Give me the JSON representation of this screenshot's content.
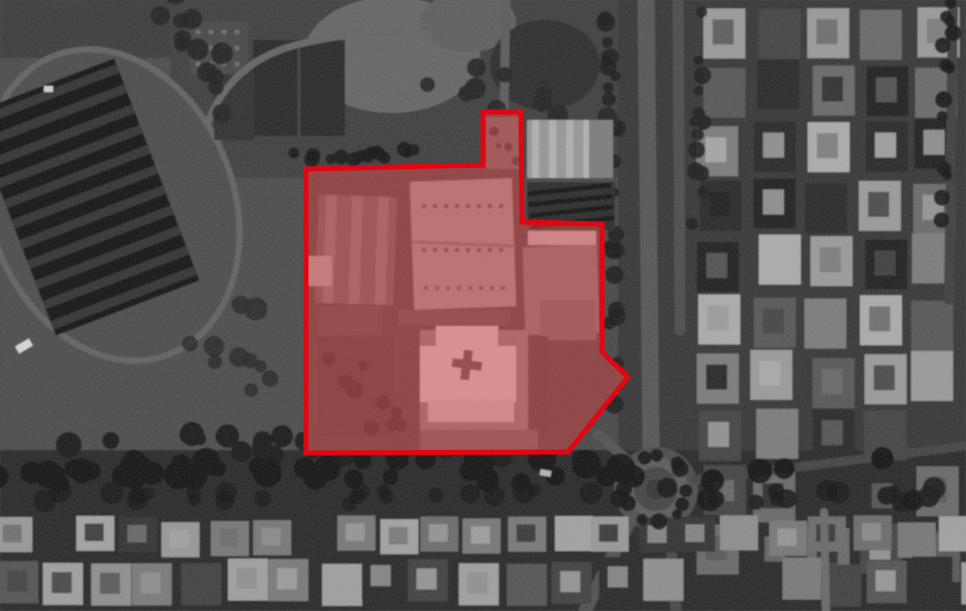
{
  "scene": {
    "kind": "grayscale-satellite-image-with-annotation",
    "palette": {
      "ground": "#484848",
      "shadow": "#141414",
      "road": "#565656",
      "roof_light": "#bfbfbf",
      "annotation_red": "#e20613"
    },
    "annotation": {
      "label": "area-of-interest-outline",
      "stroke_color": "#e20613",
      "stroke_width": 5,
      "fill_color": "#ff5252",
      "fill_opacity": 0.42,
      "points": [
        [
          306,
          169
        ],
        [
          483,
          165
        ],
        [
          483,
          112
        ],
        [
          521,
          112
        ],
        [
          522,
          222
        ],
        [
          602,
          224
        ],
        [
          602,
          352
        ],
        [
          628,
          377
        ],
        [
          568,
          452
        ],
        [
          306,
          453
        ]
      ]
    },
    "features": [
      {
        "name": "ground",
        "type": "rect",
        "x": -10,
        "y": -10,
        "w": 986,
        "h": 631,
        "fill": "#484848"
      },
      {
        "name": "field-west",
        "type": "rect",
        "x": 0,
        "y": 55,
        "w": 305,
        "h": 400,
        "fill": "#4d4d4d"
      },
      {
        "name": "top-left-band",
        "type": "rect",
        "x": 0,
        "y": 0,
        "w": 185,
        "h": 58,
        "fill": "#3e3e3e"
      },
      {
        "name": "top-center-ground",
        "type": "rect",
        "x": 170,
        "y": 0,
        "w": 465,
        "h": 178,
        "fill": "#404040"
      },
      {
        "name": "east-urban-base",
        "type": "rect",
        "x": 618,
        "y": 0,
        "w": 348,
        "h": 611,
        "fill": "#373737"
      },
      {
        "name": "south-band",
        "type": "rect",
        "x": 0,
        "y": 450,
        "w": 966,
        "h": 161,
        "fill": "#2a2a2a"
      },
      {
        "name": "track-loop",
        "type": "ellipse",
        "cx": 112,
        "cy": 205,
        "rx": 122,
        "ry": 160,
        "rot": -21,
        "fill": "#4e4e4e",
        "stroke": "#646464",
        "sw": 6
      },
      {
        "name": "stadium-roof",
        "type": "rect",
        "x": 8,
        "y": 78,
        "w": 154,
        "h": 238,
        "rot": -21,
        "fill": "#191919"
      },
      {
        "name": "stadium-roof-stripes",
        "type": "stripes",
        "x": 8,
        "y": 78,
        "w": 154,
        "h": 238,
        "rot": -21,
        "count": 11,
        "dir": "h",
        "fill": "#353535"
      },
      {
        "name": "bare-ground-patch",
        "type": "ellipse",
        "cx": 392,
        "cy": 55,
        "rx": 88,
        "ry": 58,
        "fill": "#666666"
      },
      {
        "name": "bare-ground-patch-2",
        "type": "ellipse",
        "cx": 468,
        "cy": 22,
        "rx": 48,
        "ry": 30,
        "fill": "#5e5e5e"
      },
      {
        "name": "tree-mass-north",
        "type": "ellipse",
        "cx": 545,
        "cy": 65,
        "rx": 55,
        "ry": 45,
        "fill": "#2d2d2d"
      },
      {
        "name": "warehouse-north-a",
        "type": "rect",
        "x": 253,
        "y": 40,
        "w": 92,
        "h": 96,
        "fill": "#2a2a2a"
      },
      {
        "name": "warehouse-north-a-ridge",
        "type": "line",
        "x1": 299,
        "y1": 40,
        "x2": 299,
        "y2": 136,
        "stroke": "#3f3f3f",
        "sw": 3
      },
      {
        "name": "warehouse-north-b",
        "type": "rect",
        "x": 214,
        "y": 62,
        "w": 40,
        "h": 78,
        "fill": "#323232"
      },
      {
        "name": "vent-roof",
        "type": "rect",
        "x": 190,
        "y": 22,
        "w": 58,
        "h": 52,
        "fill": "#4a4a4a"
      },
      {
        "name": "vent-roof-dots",
        "type": "dots",
        "x": 198,
        "y": 32,
        "cols": 4,
        "rows": 3,
        "dx": 13,
        "dy": 16,
        "r": 2.5,
        "fill": "#6e6e6e"
      },
      {
        "name": "access-road-north",
        "type": "path",
        "d": "M 208,122 Q 232,60 300,44 T 428,34",
        "stroke": "#656565",
        "sw": 7
      },
      {
        "name": "north-road",
        "type": "line",
        "x1": 506,
        "y1": 0,
        "x2": 504,
        "y2": 112,
        "stroke": "#5c5c5c",
        "sw": 9
      },
      {
        "name": "urban-grid-east",
        "type": "grid",
        "x": 700,
        "y": 6,
        "cols": 6,
        "rows": 10,
        "cw": 42,
        "ch": 50,
        "gx": 12,
        "gy": 8,
        "seed": 31,
        "jitter": 5,
        "skip": 0.06,
        "inner": true,
        "palette": [
          "#9a9a9a",
          "#7b7b7b",
          "#595959",
          "#2c2c2c",
          "#ababab",
          "#454545",
          "#6a6a6a",
          "#242424"
        ]
      },
      {
        "name": "right-edge-road",
        "type": "line",
        "x1": 953,
        "y1": 0,
        "x2": 949,
        "y2": 300,
        "stroke": "#414141",
        "sw": 10
      },
      {
        "name": "boulevard-west-lane",
        "type": "path",
        "d": "M 646,0 L 651,447",
        "stroke": "#565656",
        "sw": 17
      },
      {
        "name": "boulevard-east-lane",
        "type": "path",
        "d": "M 678,0 L 680,330",
        "stroke": "#4d4d4d",
        "sw": 11
      },
      {
        "name": "roundabout-pad",
        "type": "circle",
        "cx": 656,
        "cy": 489,
        "r": 42,
        "fill": "#4e4e4e"
      },
      {
        "name": "roundabout-ring",
        "type": "circle",
        "cx": 656,
        "cy": 489,
        "r": 27,
        "fill": "#444444",
        "stroke": "#5d5d5d",
        "sw": 10
      },
      {
        "name": "roundabout-island",
        "type": "circle",
        "cx": 656,
        "cy": 489,
        "r": 10,
        "fill": "#383838"
      },
      {
        "name": "road-southwest",
        "type": "line",
        "x1": 633,
        "y1": 515,
        "x2": 585,
        "y2": 611,
        "stroke": "#515151",
        "sw": 13
      },
      {
        "name": "road-south",
        "type": "line",
        "x1": 669,
        "y1": 522,
        "x2": 676,
        "y2": 611,
        "stroke": "#494949",
        "sw": 11
      },
      {
        "name": "road-east",
        "type": "line",
        "x1": 694,
        "y1": 480,
        "x2": 966,
        "y2": 446,
        "stroke": "#454545",
        "sw": 9
      },
      {
        "name": "road-northwest-stub",
        "type": "line",
        "x1": 626,
        "y1": 459,
        "x2": 598,
        "y2": 434,
        "stroke": "#525252",
        "sw": 10
      },
      {
        "name": "bottom-house-row-1",
        "type": "grid",
        "x": -8,
        "y": 519,
        "cols": 23,
        "rows": 1,
        "cw": 38,
        "ch": 35,
        "gx": 5,
        "gy": 0,
        "seed": 32,
        "jitter": 4,
        "skip": 0.05,
        "inner": true,
        "palette": [
          "#8d8d8d",
          "#a2a2a2",
          "#6d6d6d",
          "#343434",
          "#787878",
          "#989898"
        ]
      },
      {
        "name": "bottom-house-row-2",
        "type": "grid",
        "x": -4,
        "y": 560,
        "cols": 22,
        "rows": 1,
        "cw": 40,
        "ch": 42,
        "gx": 6,
        "gy": 0,
        "seed": 33,
        "jitter": 5,
        "skip": 0.05,
        "inner": true,
        "palette": [
          "#555555",
          "#7a7a7a",
          "#2b2b2b",
          "#8f8f8f",
          "#424242",
          "#9f9f9f"
        ]
      },
      {
        "name": "bottom-road-vertical",
        "type": "line",
        "x1": 824,
        "y1": 512,
        "x2": 826,
        "y2": 611,
        "stroke": "#6b6b6b",
        "sw": 8
      },
      {
        "name": "tree-row-field-south",
        "type": "blobs",
        "x1": 10,
        "y1": 441,
        "x2": 600,
        "y2": 450,
        "count": 30,
        "rmin": 6,
        "rmax": 13,
        "spread": 10,
        "seed": 11,
        "fill": "#1b1b1b"
      },
      {
        "name": "tree-band-south",
        "type": "blobs",
        "x1": 0,
        "y1": 472,
        "x2": 966,
        "y2": 468,
        "count": 48,
        "rmin": 8,
        "rmax": 15,
        "spread": 13,
        "seed": 12,
        "fill": "#141414"
      },
      {
        "name": "tree-band-south-2",
        "type": "blobs",
        "x1": 0,
        "y1": 498,
        "x2": 966,
        "y2": 494,
        "count": 40,
        "rmin": 6,
        "rmax": 12,
        "spread": 9,
        "seed": 18,
        "fill": "#1a1a1a"
      },
      {
        "name": "boulevard-median-trees",
        "type": "blobs",
        "x1": 612,
        "y1": 8,
        "x2": 610,
        "y2": 438,
        "count": 26,
        "rmin": 5,
        "rmax": 10,
        "spread": 7,
        "seed": 13,
        "fill": "#1e1e1e"
      },
      {
        "name": "boulevard-east-trees",
        "type": "blobs",
        "x1": 700,
        "y1": 0,
        "x2": 697,
        "y2": 300,
        "count": 16,
        "rmin": 5,
        "rmax": 9,
        "spread": 6,
        "seed": 14,
        "fill": "#212121"
      },
      {
        "name": "right-edge-trees",
        "type": "blobs",
        "x1": 948,
        "y1": 0,
        "x2": 944,
        "y2": 280,
        "count": 14,
        "rmin": 5,
        "rmax": 9,
        "spread": 6,
        "seed": 15,
        "fill": "#191919"
      },
      {
        "name": "roundabout-trees",
        "type": "ring",
        "cx": 656,
        "cy": 489,
        "r": 32,
        "count": 12,
        "rmin": 5,
        "rmax": 9,
        "seed": 16,
        "fill": "#181818"
      },
      {
        "name": "field-scrub",
        "type": "blobs",
        "x1": 215,
        "y1": 310,
        "x2": 300,
        "y2": 425,
        "count": 10,
        "rmin": 6,
        "rmax": 12,
        "spread": 35,
        "seed": 17,
        "fill": "#2a2a2a"
      },
      {
        "name": "tree-mass-top-center",
        "type": "blobs",
        "x1": 178,
        "y1": 10,
        "x2": 255,
        "y2": 135,
        "count": 12,
        "rmin": 7,
        "rmax": 13,
        "spread": 20,
        "seed": 22,
        "fill": "#232323"
      },
      {
        "name": "tree-row-north-of-aoi",
        "type": "blobs",
        "x1": 292,
        "y1": 157,
        "x2": 478,
        "y2": 151,
        "count": 15,
        "rmin": 5,
        "rmax": 8,
        "spread": 5,
        "seed": 21,
        "fill": "#191919"
      },
      {
        "name": "tree-scatter-northeast",
        "type": "blobs",
        "x1": 430,
        "y1": 75,
        "x2": 608,
        "y2": 115,
        "count": 13,
        "rmin": 6,
        "rmax": 11,
        "spread": 22,
        "seed": 23,
        "fill": "#262626"
      },
      {
        "name": "aoi-ground",
        "type": "polygon",
        "points": [
          [
            306,
            169
          ],
          [
            483,
            165
          ],
          [
            483,
            112
          ],
          [
            521,
            112
          ],
          [
            522,
            222
          ],
          [
            602,
            224
          ],
          [
            602,
            352
          ],
          [
            628,
            377
          ],
          [
            568,
            452
          ],
          [
            306,
            453
          ]
        ],
        "fill": "#3c3c3c"
      },
      {
        "name": "west-hall",
        "type": "rect",
        "x": 317,
        "y": 196,
        "w": 78,
        "h": 108,
        "rot": 2,
        "fill": "#585858"
      },
      {
        "name": "west-hall-ridges",
        "type": "stripes",
        "x": 317,
        "y": 196,
        "w": 78,
        "h": 108,
        "rot": 2,
        "count": 3,
        "dir": "v",
        "fill": "#6f6f6f"
      },
      {
        "name": "west-hall-annex",
        "type": "rect",
        "x": 318,
        "y": 306,
        "w": 64,
        "h": 70,
        "fill": "#454545"
      },
      {
        "name": "west-bright-shed",
        "type": "rect",
        "x": 306,
        "y": 256,
        "w": 26,
        "h": 30,
        "fill": "#9b9b9b"
      },
      {
        "name": "main-hall",
        "type": "rect",
        "x": 412,
        "y": 180,
        "w": 102,
        "h": 128,
        "rot": -2,
        "fill": "#8a8a8a"
      },
      {
        "name": "main-hall-seam",
        "type": "line",
        "x1": 413,
        "y1": 242,
        "x2": 514,
        "y2": 246,
        "stroke": "#6a6a6a",
        "sw": 3
      },
      {
        "name": "main-hall-vents-1",
        "type": "dots",
        "x": 424,
        "y": 206,
        "cols": 8,
        "rows": 1,
        "dx": 11,
        "dy": 0,
        "r": 2.4,
        "fill": "#4f4f4f"
      },
      {
        "name": "main-hall-vents-2",
        "type": "dots",
        "x": 424,
        "y": 250,
        "cols": 8,
        "rows": 1,
        "dx": 11,
        "dy": 0,
        "r": 2.4,
        "fill": "#4f4f4f"
      },
      {
        "name": "main-hall-vents-3",
        "type": "dots",
        "x": 426,
        "y": 288,
        "cols": 8,
        "rows": 1,
        "dx": 11,
        "dy": 0,
        "r": 2.4,
        "fill": "#565656"
      },
      {
        "name": "east-hall-roof-strip",
        "type": "rect",
        "x": 528,
        "y": 231,
        "w": 68,
        "h": 14,
        "fill": "#aaaaaa"
      },
      {
        "name": "east-hall",
        "type": "rect",
        "x": 524,
        "y": 246,
        "w": 74,
        "h": 88,
        "rot": -2,
        "fill": "#6f6f6f"
      },
      {
        "name": "east-hall-wing",
        "type": "rect",
        "x": 540,
        "y": 300,
        "w": 56,
        "h": 40,
        "fill": "#626262"
      },
      {
        "name": "east-inner-shadow",
        "type": "rect",
        "x": 524,
        "y": 336,
        "w": 24,
        "h": 96,
        "fill": "#3a3a3a"
      },
      {
        "name": "cross-pad",
        "type": "rect",
        "x": 398,
        "y": 330,
        "w": 130,
        "h": 104,
        "fill": "#757575"
      },
      {
        "name": "cross-pad-shadow",
        "type": "rect",
        "x": 398,
        "y": 330,
        "w": 22,
        "h": 104,
        "fill": "#3d3d3d"
      },
      {
        "name": "cross-building-horizontal",
        "type": "rect",
        "x": 420,
        "y": 346,
        "w": 96,
        "h": 56,
        "fill": "#bfbfbf"
      },
      {
        "name": "cross-building-vertical",
        "type": "rect",
        "x": 436,
        "y": 326,
        "w": 62,
        "h": 96,
        "fill": "#bfbfbf"
      },
      {
        "name": "cross-apron",
        "type": "rect",
        "x": 428,
        "y": 400,
        "w": 86,
        "h": 22,
        "fill": "#b2b2b2"
      },
      {
        "name": "cross-mark-horizontal",
        "type": "rect",
        "x": 452,
        "y": 360,
        "w": 30,
        "h": 9,
        "rot": 8,
        "fill": "#4a4a4a"
      },
      {
        "name": "cross-mark-vertical",
        "type": "rect",
        "x": 462,
        "y": 350,
        "w": 9,
        "h": 30,
        "rot": 8,
        "fill": "#4a4a4a"
      },
      {
        "name": "southwest-yard",
        "type": "rect",
        "x": 318,
        "y": 336,
        "w": 76,
        "h": 100,
        "fill": "#393939"
      },
      {
        "name": "yard-structures",
        "type": "blobs",
        "x1": 325,
        "y1": 345,
        "x2": 390,
        "y2": 430,
        "count": 9,
        "rmin": 5,
        "rmax": 10,
        "spread": 18,
        "seed": 24,
        "fill": "#262626"
      },
      {
        "name": "south-strip-light",
        "type": "rect",
        "x": 420,
        "y": 430,
        "w": 118,
        "h": 20,
        "fill": "#585858"
      },
      {
        "name": "mid-lane",
        "type": "rect",
        "x": 398,
        "y": 310,
        "w": 112,
        "h": 15,
        "fill": "#4c4c4c"
      },
      {
        "name": "notch-building",
        "type": "rect",
        "x": 486,
        "y": 117,
        "w": 34,
        "h": 52,
        "fill": "#5d5d5d"
      },
      {
        "name": "notch-building-clutter",
        "type": "blobs",
        "x1": 490,
        "y1": 122,
        "x2": 514,
        "y2": 162,
        "count": 6,
        "rmin": 2,
        "rmax": 5,
        "spread": 6,
        "seed": 25,
        "fill": "#2d2d2d"
      },
      {
        "name": "northeast-warehouse",
        "type": "rect",
        "x": 527,
        "y": 120,
        "w": 86,
        "h": 58,
        "fill": "#979797"
      },
      {
        "name": "northeast-warehouse-seams",
        "type": "stripes",
        "x": 527,
        "y": 120,
        "w": 86,
        "h": 58,
        "count": 5,
        "dir": "v",
        "fill": "#b0b0b0"
      },
      {
        "name": "northeast-warehouse-shade",
        "type": "rect",
        "x": 589,
        "y": 120,
        "w": 24,
        "h": 58,
        "fill": "#7d7d7d"
      },
      {
        "name": "truck-bays-base",
        "type": "rect",
        "x": 527,
        "y": 182,
        "w": 88,
        "h": 48,
        "fill": "#2e2e2e"
      },
      {
        "name": "truck-bays",
        "type": "stripes",
        "x": 529,
        "y": 184,
        "w": 84,
        "h": 44,
        "count": 4,
        "dir": "h",
        "rot": -6,
        "fill": "#131313"
      },
      {
        "name": "vehicle-1",
        "type": "rect",
        "x": 16,
        "y": 342,
        "w": 16,
        "h": 8,
        "rot": -30,
        "fill": "#d6d6d6"
      },
      {
        "name": "vehicle-2",
        "type": "rect",
        "x": 44,
        "y": 86,
        "w": 9,
        "h": 6,
        "fill": "#cccccc"
      },
      {
        "name": "vehicle-3",
        "type": "rect",
        "x": 540,
        "y": 470,
        "w": 11,
        "h": 6,
        "rot": 10,
        "fill": "#b5b5b5"
      }
    ]
  }
}
